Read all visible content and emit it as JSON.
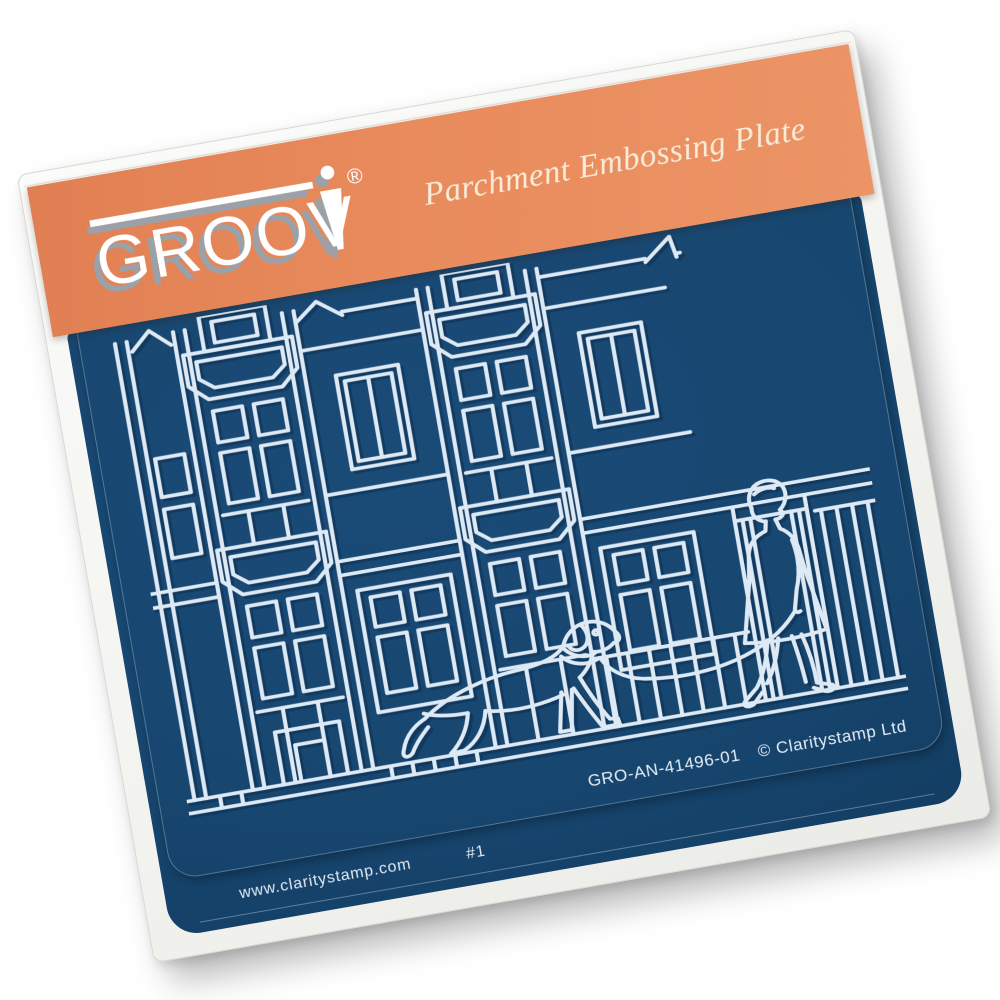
{
  "brand": {
    "logo_text": "GROOV",
    "logo_full": "GROOVI",
    "registered_mark": "®"
  },
  "header": {
    "tagline": "Parchment Embossing Plate",
    "band_color": "#e8895c",
    "tagline_color": "#f8ecd9"
  },
  "plate": {
    "product_code": "GRO-AN-41496-01",
    "copyright": "© Claritystamp Ltd",
    "base_color": "#17466f",
    "line_color": "#dde9f4"
  },
  "footer": {
    "website": "www.claritystamp.com",
    "plate_number": "#1"
  }
}
